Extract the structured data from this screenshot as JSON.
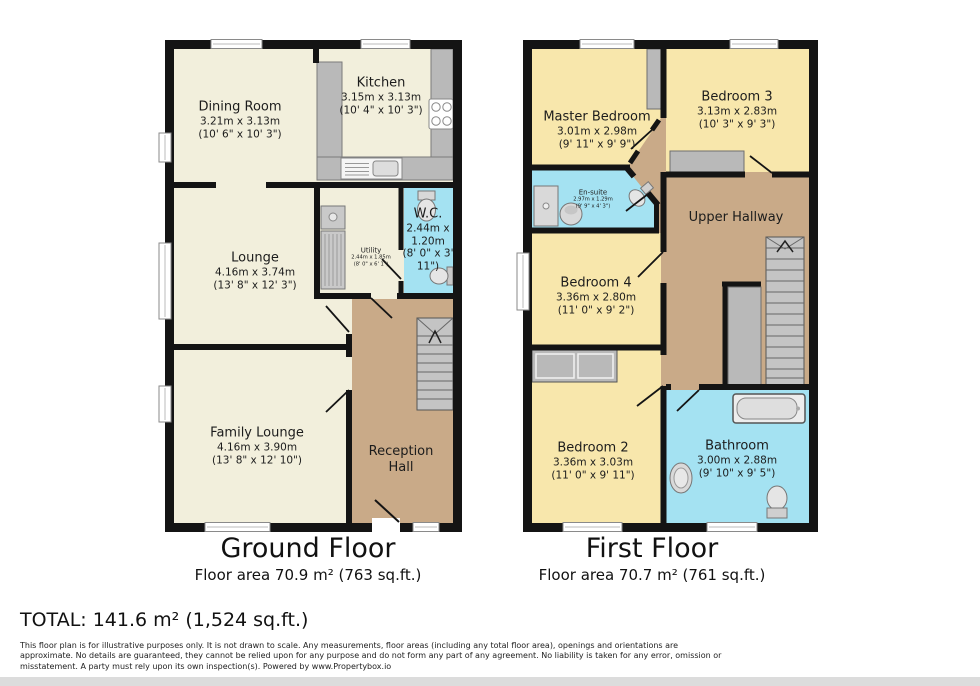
{
  "ground_floor": {
    "title": "Ground Floor",
    "area_label": "Floor area 70.9 m² (763 sq.ft.)",
    "rooms": {
      "dining_room": {
        "name": "Dining Room",
        "metric": "3.21m x 3.13m",
        "imperial": "(10' 6\" x 10' 3\")"
      },
      "kitchen": {
        "name": "Kitchen",
        "metric": "3.15m x 3.13m",
        "imperial": "(10' 4\" x 10' 3\")"
      },
      "lounge": {
        "name": "Lounge",
        "metric": "4.16m x 3.74m",
        "imperial": "(13' 8\" x 12' 3\")"
      },
      "utility": {
        "name": "Utility",
        "metric": "2.44m x 1.85m",
        "imperial": "(8' 0\" x 6' 1\")"
      },
      "wc": {
        "name": "W.C.",
        "metric": "2.44m x 1.20m",
        "imperial": "(8' 0\" x 3' 11\")"
      },
      "family_lounge": {
        "name": "Family Lounge",
        "metric": "4.16m x 3.90m",
        "imperial": "(13' 8\" x 12' 10\")"
      },
      "reception_hall": {
        "name": "Reception Hall"
      }
    }
  },
  "first_floor": {
    "title": "First Floor",
    "area_label": "Floor area 70.7 m² (761 sq.ft.)",
    "rooms": {
      "master_bedroom": {
        "name": "Master Bedroom",
        "metric": "3.01m x 2.98m",
        "imperial": "(9' 11\" x 9' 9\")"
      },
      "bedroom3": {
        "name": "Bedroom 3",
        "metric": "3.13m x 2.83m",
        "imperial": "(10' 3\" x 9' 3\")"
      },
      "ensuite": {
        "name": "En-suite",
        "metric": "2.97m x 1.29m",
        "imperial": "(9' 9\" x 4' 3\")"
      },
      "upper_hallway": {
        "name": "Upper Hallway"
      },
      "bedroom4": {
        "name": "Bedroom 4",
        "metric": "3.36m x 2.80m",
        "imperial": "(11' 0\" x 9' 2\")"
      },
      "bedroom2": {
        "name": "Bedroom 2",
        "metric": "3.36m x 3.03m",
        "imperial": "(11' 0\" x 9' 11\")"
      },
      "bathroom": {
        "name": "Bathroom",
        "metric": "3.00m x 2.88m",
        "imperial": "(9' 10\" x 9' 5\")"
      }
    }
  },
  "total_label": "TOTAL: 141.6 m² (1,524 sq.ft.)",
  "disclaimer_lines": [
    "This floor plan is for illustrative purposes only. It is not drawn to scale. Any measurements, floor areas (including any total floor area), openings and orientations are",
    "approximate. No details are guaranteed, they cannot be relied upon for any purpose and do not form any part of any agreement. No liability is taken for any error, omission or",
    "misstatement. A party must rely upon its own inspection(s). Powered by www.Propertybox.io"
  ],
  "colors": {
    "wall": "#141414",
    "ground_room": "#f2efdc",
    "bedroom_yellow": "#f8e7ac",
    "wet_room_blue": "#a4e2f2",
    "hallway_tan": "#c9aa88",
    "fixture_gray": "#b9b9b9"
  }
}
